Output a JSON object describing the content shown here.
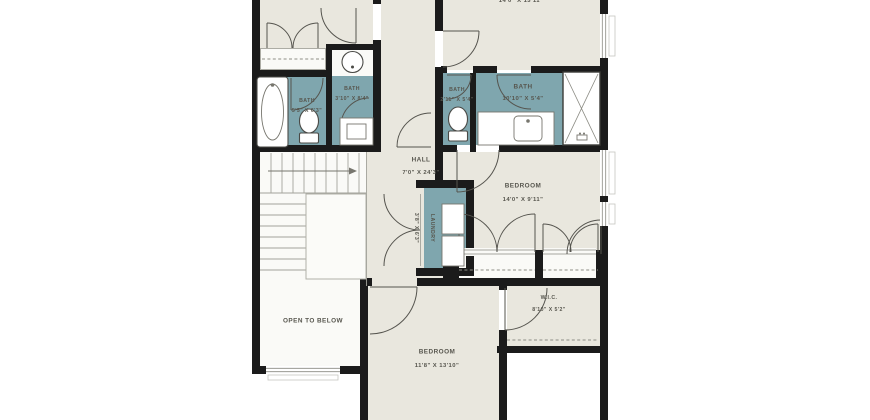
{
  "rooms": {
    "bedroom_top": {
      "dims": "14'0\" X 13'11\""
    },
    "bath_tub": {
      "label": "BATH",
      "dims": "5'5\" X 6'3\""
    },
    "bath_hall": {
      "label": "BATH",
      "dims": "3'10\" X 8'4\""
    },
    "bath_wc": {
      "label": "BATH",
      "dims": "2'11\" X 5'4\""
    },
    "bath_ensuite": {
      "label": "BATH",
      "dims": "10'10\" X 5'4\""
    },
    "hall": {
      "label": "HALL",
      "dims": "7'0\" X 24'3\""
    },
    "bedroom_right": {
      "label": "BEDROOM",
      "dims": "14'0\" X 9'11\""
    },
    "laundry": {
      "label": "LAUNDRY",
      "dims": "3'8\" X 6'3\""
    },
    "wic": {
      "label": "W.I.C.",
      "dims": "8'10\" X 5'2\""
    },
    "bedroom_bottom": {
      "label": "BEDROOM",
      "dims": "11'8\" X 13'10\""
    },
    "open_to_below": {
      "label": "OPEN TO BELOW"
    }
  },
  "colors": {
    "wall": "#1b1b1b",
    "floor": "#e9e7de",
    "wet_room": "#7fa6ae",
    "stair_floor": "#fafaf7",
    "outside": "#ffffff",
    "label_text": "#57564e"
  }
}
